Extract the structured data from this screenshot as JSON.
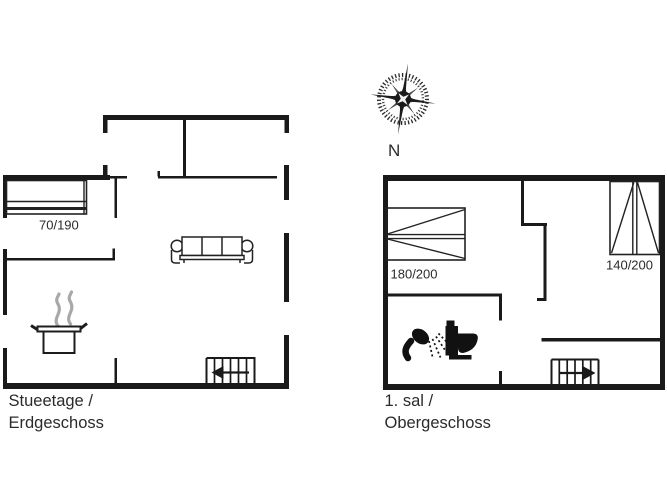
{
  "compass": {
    "label": "N"
  },
  "floors": {
    "ground": {
      "title_line1": "Stueetage /",
      "title_line2": "Erdgeschoss",
      "bed1_size": "70/190"
    },
    "upper": {
      "title_line1": "1. sal /",
      "title_line2": "Obergeschoss",
      "bed_left_size": "180/200",
      "bed_right_size": "140/200"
    }
  },
  "icons": {
    "compass": "compass-rose-icon",
    "bed": "bed-icon",
    "sofa": "sofa-icon",
    "pot": "cooking-pot-icon",
    "steam": "steam-icon",
    "shower": "shower-icon",
    "toilet": "toilet-icon",
    "stairs": "stairs-icon"
  },
  "colors": {
    "wall": "#1a1a1a",
    "text": "#2b2b2b",
    "steam": "#a8a8a8",
    "background": "#ffffff"
  }
}
